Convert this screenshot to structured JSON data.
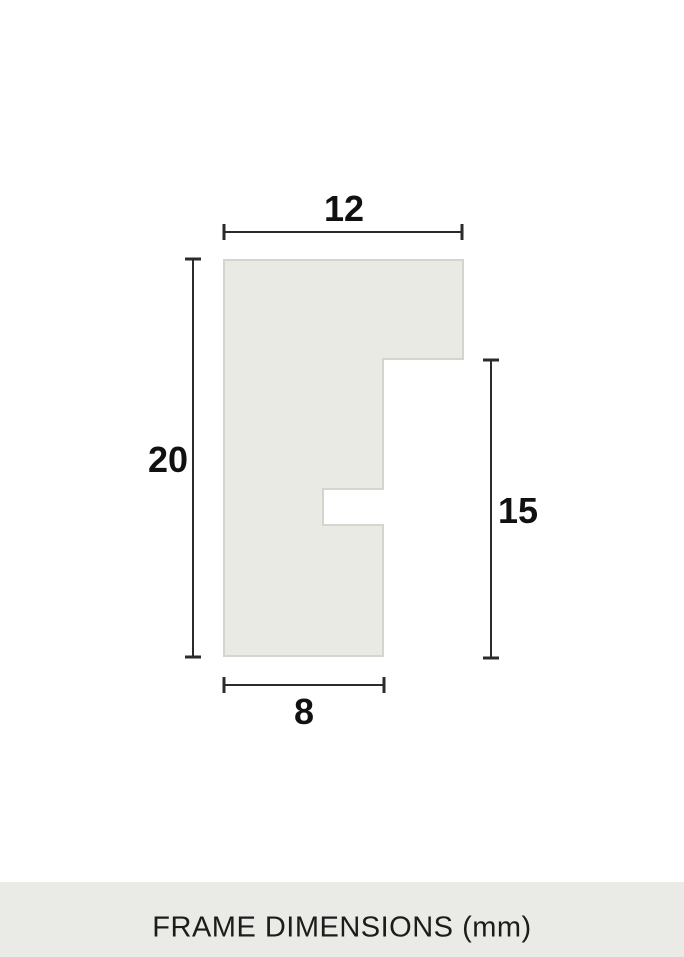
{
  "figure": {
    "name": "frame-profile-cross-section",
    "dimensions": {
      "top_width": "12",
      "left_height": "20",
      "right_height": "15",
      "bottom_width": "8"
    }
  },
  "footer": {
    "caption": "FRAME DIMENSIONS (mm)"
  },
  "colors": {
    "page_bg": "#ffffff",
    "shape_fill": "#eaeae5",
    "shape_border": "#d5d5d0",
    "dim_line": "#2b2b2b",
    "label_text": "#111111",
    "footer_bg": "#eaeae6",
    "footer_text": "#1c1c1c"
  }
}
